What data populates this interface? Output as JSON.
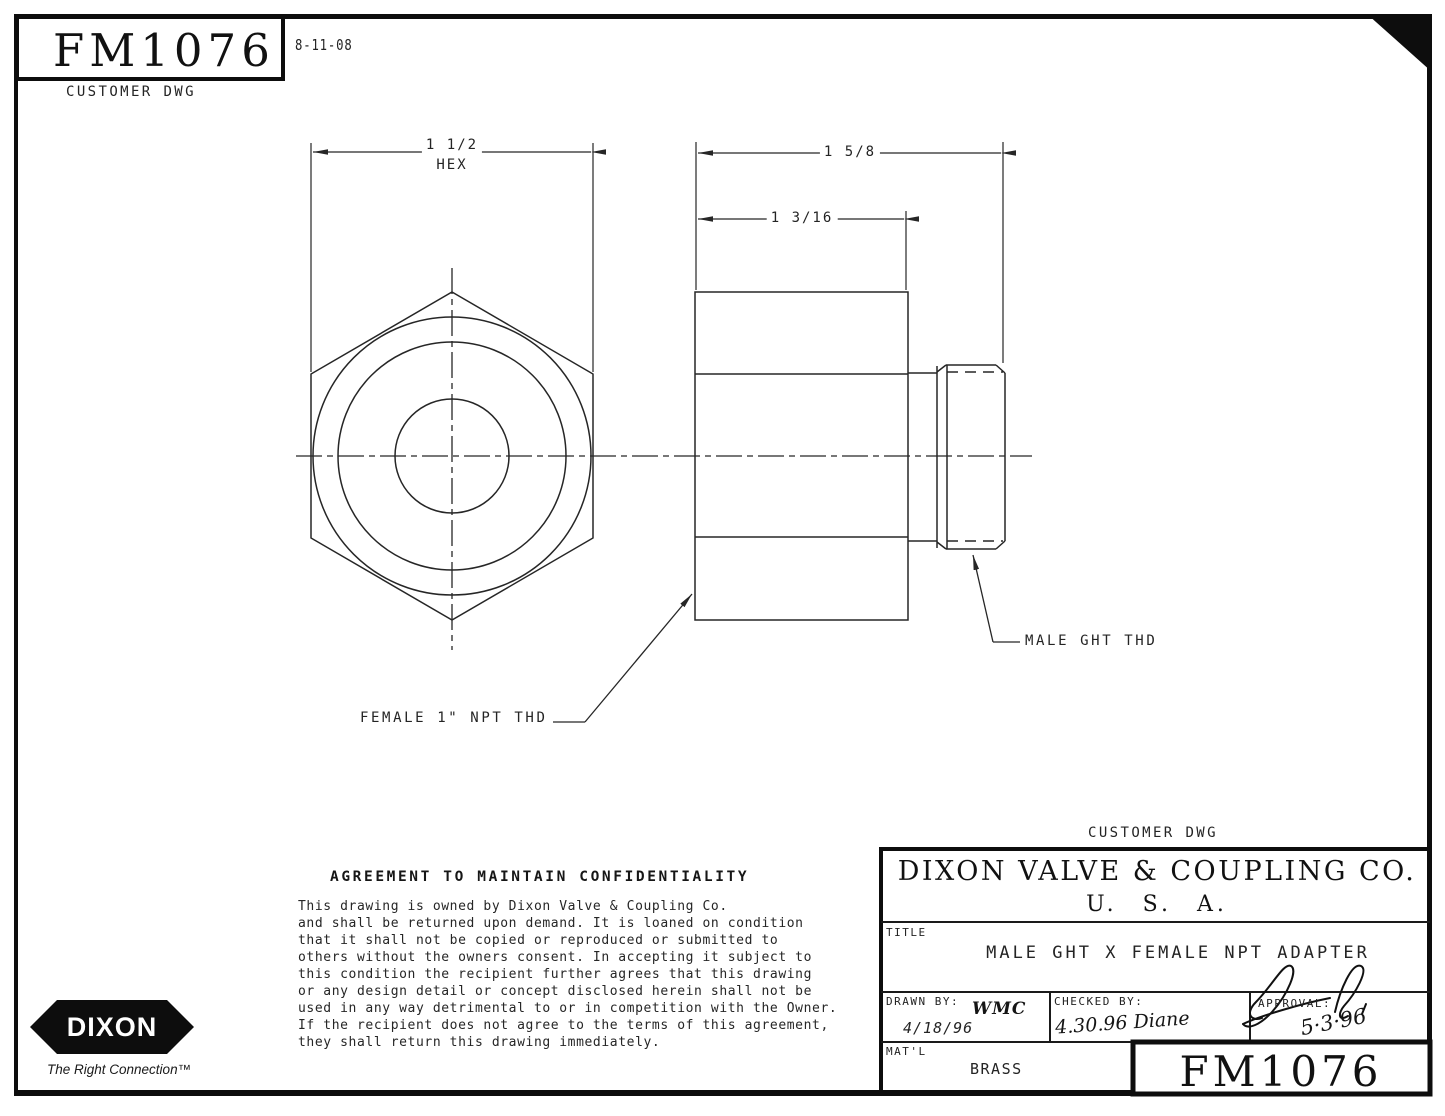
{
  "meta": {
    "part_number": "FM1076",
    "revision_date": "8-11-08",
    "customer_dwg": "CUSTOMER DWG"
  },
  "dimensions": {
    "hex_width": "1 1/2",
    "hex_label": "HEX",
    "overall_length": "1 5/8",
    "body_length": "1 3/16"
  },
  "callouts": {
    "female_thread": "FEMALE 1\" NPT THD",
    "male_thread": "MALE GHT THD"
  },
  "agreement": {
    "heading": "AGREEMENT TO MAINTAIN CONFIDENTIALITY",
    "lines": [
      "This drawing is owned by Dixon Valve & Coupling Co.",
      "and shall be returned upon demand.  It is loaned on condition",
      "that it shall not be copied or reproduced or submitted to",
      "others without the owners consent.  In accepting it subject to",
      "this condition the recipient further agrees that this drawing",
      "or any design detail or concept disclosed herein shall not be",
      "used in any way detrimental to or in competition with the Owner.",
      "If the recipient does not agree to the terms of this agreement,",
      "they shall return this drawing immediately."
    ]
  },
  "title_block": {
    "customer_dwg": "CUSTOMER DWG",
    "company": "DIXON VALVE & COUPLING CO.",
    "country": "U.  S.  A.",
    "title_label": "TITLE",
    "title": "MALE GHT X FEMALE NPT ADAPTER",
    "drawn_by_label": "DRAWN BY:",
    "drawn_by": "WMC",
    "drawn_date": "4/18/96",
    "checked_by_label": "CHECKED BY:",
    "checked_by": "4.30.96 Diane",
    "approval_label": "APPROVAL:",
    "approval_date": "5·3·96",
    "material_label": "MAT'L",
    "material": "BRASS",
    "part_number": "FM1076"
  },
  "logo": {
    "name": "DIXON",
    "tagline": "The Right Connection™"
  },
  "colors": {
    "ink": "#262626",
    "heavy_ink": "#0d0d0d",
    "paper": "#ffffff"
  }
}
